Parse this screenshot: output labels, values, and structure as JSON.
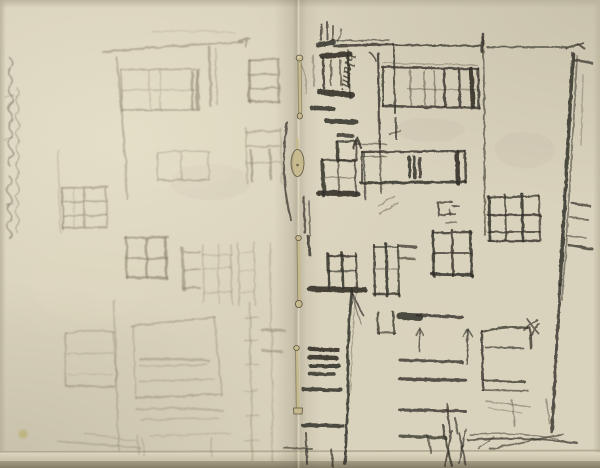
{
  "artwork": {
    "type": "graphite pencil sketch in an open sketchbook",
    "subject": "Studies of building facades with rows of paned windows on two pages joined by a pinned binding",
    "left_page": "very faint light pencil facade with gridded windows and a margin inscription",
    "right_page": "darker pencil facade: cornice line, stepped-gable marks, window grids, sill rows, drainpipe, up-arrows and ground scribbles"
  },
  "inscriptions": {
    "annotation": "blum.",
    "left_margin": "faint vertical cursive inscription (illegible)"
  },
  "palette": {
    "paper": "#d9d2bc",
    "paper_light": "#e6dfc8",
    "paper_edge": "#c2bba3",
    "page_bottom_edge": "#928a72",
    "ink_dark": "#33312a",
    "ink_mid": "#5f5a4b",
    "ink_faint": "#837b64",
    "brass": "#c6ba8e",
    "brass_dark": "#5c5542",
    "stain": "#b1a554"
  },
  "binding": {
    "pins": [
      "round-head pin (top)",
      "oval clasp",
      "round-head pin (middle)",
      "flat-end pin (bottom)"
    ]
  }
}
